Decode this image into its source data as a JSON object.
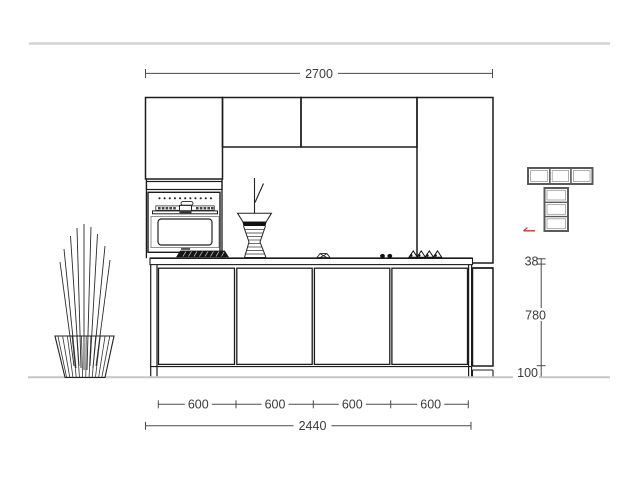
{
  "dimensions": {
    "overall_width": "2700",
    "unit_widths": [
      "600",
      "600",
      "600",
      "600"
    ],
    "run_length": "2440",
    "worktop_thickness": "38",
    "carcass_height": "780",
    "plinth_height": "100"
  },
  "colors": {
    "line": "#1c1c1c",
    "dimension_line": "#4a4a4a",
    "label_text": "#3b3b3b",
    "guide_line": "#cccccc",
    "accent_red": "#bf3a2b"
  }
}
